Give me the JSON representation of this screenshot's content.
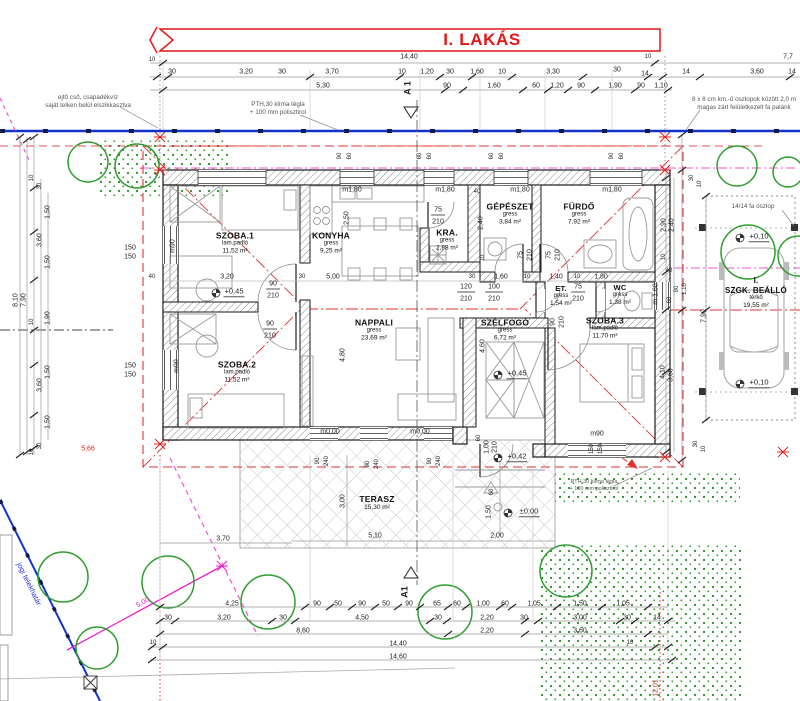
{
  "title": "I. LAKÁS",
  "section": {
    "top": "A 1",
    "bottom": "A1"
  },
  "notes": {
    "left1": "ejtő cső, csapadékvíz",
    "left2": "saját telken belül elszikkasztva",
    "mid1": "PTH,30 klíma tégla",
    "mid2": "+ 100 mm polisztirol",
    "right1": "8 x 8 cm km.-ű oszlopok között 2,0 m",
    "right2": "magas zárt felületkezelt fa palánk",
    "post": "14/14 fa oszlop",
    "brick1": "PTH 30 klíma tégla",
    "brick2": "+ 100 mm polisztirol",
    "plot": "jogi telekhatár"
  },
  "rooms": [
    {
      "name": "SZOBA.1",
      "floor": "lam.padló",
      "area": "11,52 m²"
    },
    {
      "name": "KONYHA",
      "floor": "gress",
      "area": "9,25 m²"
    },
    {
      "name": "KRA.",
      "floor": "gress",
      "area": "2,88 m²"
    },
    {
      "name": "GÉPÉSZET",
      "floor": "gress",
      "area": "3,84 m²"
    },
    {
      "name": "FÜRDŐ",
      "floor": "gress",
      "area": "7,92 m²"
    },
    {
      "name": "ET.",
      "floor": "gress",
      "area": "1,54 m²"
    },
    {
      "name": "WC",
      "floor": "gress",
      "area": "1,38 m²"
    },
    {
      "name": "NAPPALI",
      "floor": "gress",
      "area": "23,69 m²"
    },
    {
      "name": "SZÉLFOGÓ",
      "floor": "gress",
      "area": "6,72 m²"
    },
    {
      "name": "SZOBA.2",
      "floor": "lam.padló",
      "area": "11,52 m²"
    },
    {
      "name": "SZOBA.3",
      "floor": "lam.padló",
      "area": "11,70 m²"
    },
    {
      "name": "TERASZ",
      "floor": "",
      "area": "15,30 m²"
    }
  ],
  "carport": {
    "line1": "I.",
    "line2": "SZGK. BEÁLLÓ",
    "floor": "térkő",
    "area": "19,55 m²"
  },
  "levels": [
    "+0,45",
    "+0,45",
    "+0,42",
    "±0,00",
    "+0,10",
    "+0,10",
    "m0,00",
    "m0,00"
  ],
  "dims": {
    "t1": [
      "14,40",
      "10",
      "10"
    ],
    "t2": [
      "30",
      "3,20",
      "30",
      "3,70",
      "10",
      "1,20",
      "30",
      "1,60",
      "10",
      "3,30",
      "30",
      "14",
      "14",
      "3,60",
      "14",
      "7,7"
    ],
    "t3": [
      "5,30",
      "90",
      "1,60",
      "60",
      "1,20",
      "90",
      "1,90",
      "90",
      "1,10"
    ],
    "b1": [
      "4,25",
      "90",
      "50",
      "90",
      "50",
      "90",
      "65",
      "60",
      "1,00",
      "60",
      "1,05",
      "1,50",
      "1,05"
    ],
    "b2": [
      "30",
      "3,20",
      "30",
      "4,50",
      "30",
      "2,20",
      "30",
      "3,00",
      "30",
      "14"
    ],
    "b3": [
      "8,60",
      "2,20",
      "3,60"
    ],
    "b4": [
      "14,40",
      "10",
      "10"
    ],
    "b5": [
      "14,60"
    ],
    "left": [
      "8,10",
      "7,90",
      "10",
      "30",
      "1,50",
      "1,50",
      "3,60",
      "1,90",
      "10",
      "1,50",
      "3,60",
      "1,50",
      "30",
      "10",
      "150",
      "150",
      "150",
      "150",
      "40",
      "5,66"
    ],
    "right": [
      "30",
      "10",
      "2,90",
      "2,40",
      "10",
      "40",
      "90",
      "1,10",
      "60",
      "7,90",
      "4,10",
      "3,60",
      "30",
      "10",
      "m 1,60"
    ],
    "inner": [
      "3,20",
      "30",
      "5,00",
      "2,50",
      "40",
      "2,40",
      "10",
      "30",
      "1,60",
      "10",
      "1,40",
      "10",
      "1,80",
      "4,80",
      "4,60",
      "3,00",
      "5,10",
      "2,00",
      "3,70",
      "1,50",
      "60",
      "12,01",
      "5,00"
    ],
    "lintel": [
      "90",
      "60",
      "60",
      "60",
      "60",
      "60",
      "90",
      "60"
    ],
    "open": [
      "m1,80",
      "m1,80",
      "m1,80",
      "m1,80",
      "75",
      "210",
      "120",
      "210",
      "100",
      "210",
      "75",
      "210",
      "75",
      "210",
      "75",
      "210",
      "90",
      "210",
      "90",
      "210",
      "90",
      "210",
      "1,00",
      "210",
      "60",
      "90",
      "240",
      "90",
      "240",
      "90",
      "240",
      "m90",
      "m90",
      "m90",
      "150",
      "150"
    ]
  }
}
